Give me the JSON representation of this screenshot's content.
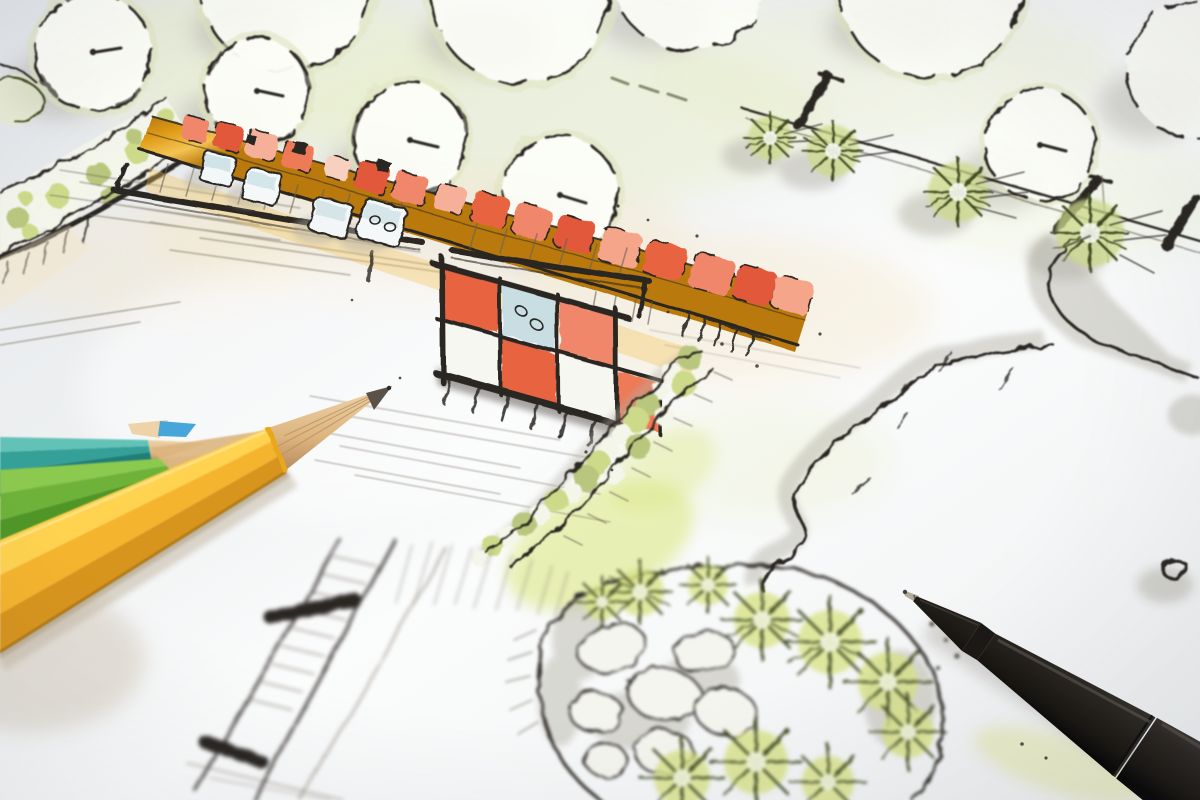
{
  "scene": {
    "type": "photograph",
    "subject": "Hand-drawn landscape architecture garden plan sketch in ink and watercolor, photographed at an angle with shallow depth of field; colored pencils and a black fineliner pen rest on the paper",
    "objects": [
      {
        "name": "garden-plan-sheet",
        "features": [
          "tree canopy symbols with center dots",
          "amber pathway band with red paving blocks",
          "tiled patio grid",
          "stepping stones with double-circle marks",
          "fence line with spiky shrubs",
          "free-form planting bed outlines with gray shadow wash",
          "rock and ornamental-grass planting bed",
          "hatched footpath lines",
          "green pebble hedge band"
        ]
      },
      {
        "name": "colored-pencil-teal",
        "color": "#35a098"
      },
      {
        "name": "colored-pencil-green",
        "color": "#6fb23a"
      },
      {
        "name": "colored-pencil-blue-tip",
        "color": "#46a5d9"
      },
      {
        "name": "colored-pencil-yellow",
        "color": "#f5b42e"
      },
      {
        "name": "fineliner-pen",
        "color": "#17140f"
      }
    ]
  },
  "palette": {
    "paper": "#eff1f2",
    "paper_bright": "#fbfcfc",
    "paper_shade": "#e3e6ea",
    "ink": "#2b2823",
    "ink_soft": "#6b6252",
    "wash_gray": "#b2afa3",
    "shadow_cool": "#b4b2a9",
    "shadow_warm": "#cfc4b2",
    "tree_fill": "#fcfdf8",
    "green_wash": "#dfe5c0",
    "green_pale": "#e9efc8",
    "green_light": "#cdda8a",
    "green_mid": "#7d8f45",
    "green_dark": "#3f4c22",
    "pebble": "#b9c77e",
    "cream_warm": "#f5e7c8",
    "amber": "#e09b18",
    "amber_dark": "#b9790e",
    "amber_light": "#f3c452",
    "red": "#e2583a",
    "red_light": "#f0876a",
    "red_pale": "#f6b09a",
    "tile_blue": "#c2dbe0",
    "pencil_teal": "#35a098",
    "pencil_teal_light": "#63c2b8",
    "pencil_teal_dark": "#1f7f78",
    "pencil_green": "#6fb23a",
    "pencil_green_light": "#8cc94f",
    "pencil_green_dark": "#4f9627",
    "pencil_yellow": "#f5b42e",
    "pencil_yellow_light": "#ffd24f",
    "pencil_yellow_dark": "#d8951d",
    "pencil_yellow_deep": "#a8700f",
    "pencil_blue": "#46a5d9",
    "wood": "#dcb57f",
    "wood_light": "#eed3a8",
    "wood_dark": "#b98c5e",
    "lead": "#5a5248",
    "pen_dark": "#17140f",
    "pen_mid": "#2c2722",
    "pen_light": "#4a443e",
    "pen_metal": "#b3aa9c"
  }
}
